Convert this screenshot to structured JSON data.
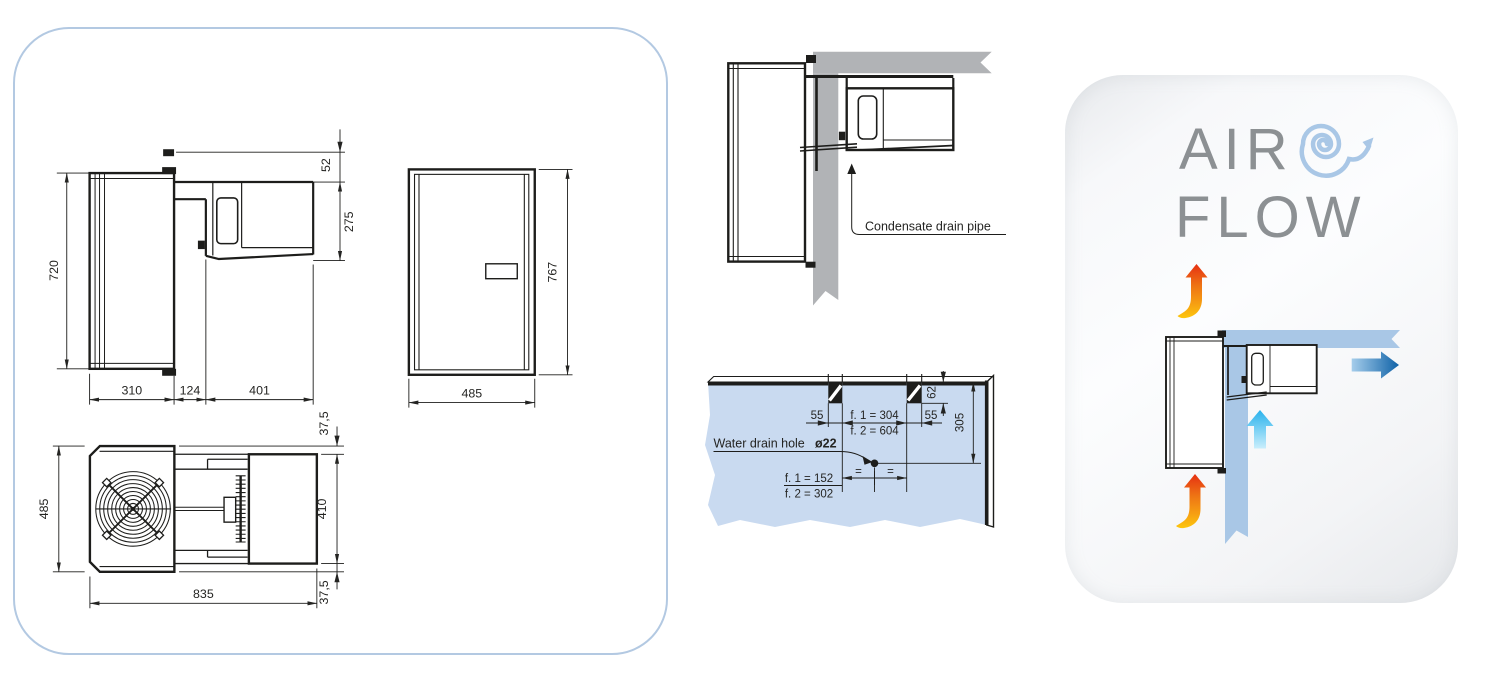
{
  "colors": {
    "panel_border_blue": "#b3c9e2",
    "drawing_line": "#1d1d1b",
    "wall_gray": "#b1b3b6",
    "wall_blue": "#c9daf0",
    "airflow_blue": "#a9c7e6",
    "arrow_dark_blue": "#0f62a7",
    "arrow_cyan": "#29b2ec",
    "arrow_warm_red": "#e63012",
    "arrow_warm_yellow": "#fdc60e",
    "airflow_text_gray": "#8c9093"
  },
  "left_panel": {
    "side_view": {
      "height": "720",
      "hook_offset": "52",
      "unit_height": "275",
      "inside_depth": "310",
      "wall_thickness": "124",
      "outside_depth": "401"
    },
    "front_view": {
      "width": "485",
      "height": "767"
    },
    "top_view": {
      "width": "485",
      "length": "835",
      "unit_width": "410",
      "margin_top": "37,5",
      "margin_bottom": "37,5"
    }
  },
  "installation": {
    "condensate_label": "Condensate drain pipe",
    "water_drain_label": "Water drain hole",
    "hole_diameter": "ø22",
    "slot_width_left": "55",
    "slot_width_right": "55",
    "slot_span_f1": "f. 1 = 304",
    "slot_span_f2": "f. 2 = 604",
    "slot_depth": "62",
    "hole_drop": "305",
    "hole_offset_f1": "f. 1 = 152",
    "hole_offset_f2": "f. 2 = 302",
    "equal_left": "=",
    "equal_right": "="
  },
  "airflow_panel": {
    "title_line1": "AIR",
    "title_line2": "FLOW"
  }
}
